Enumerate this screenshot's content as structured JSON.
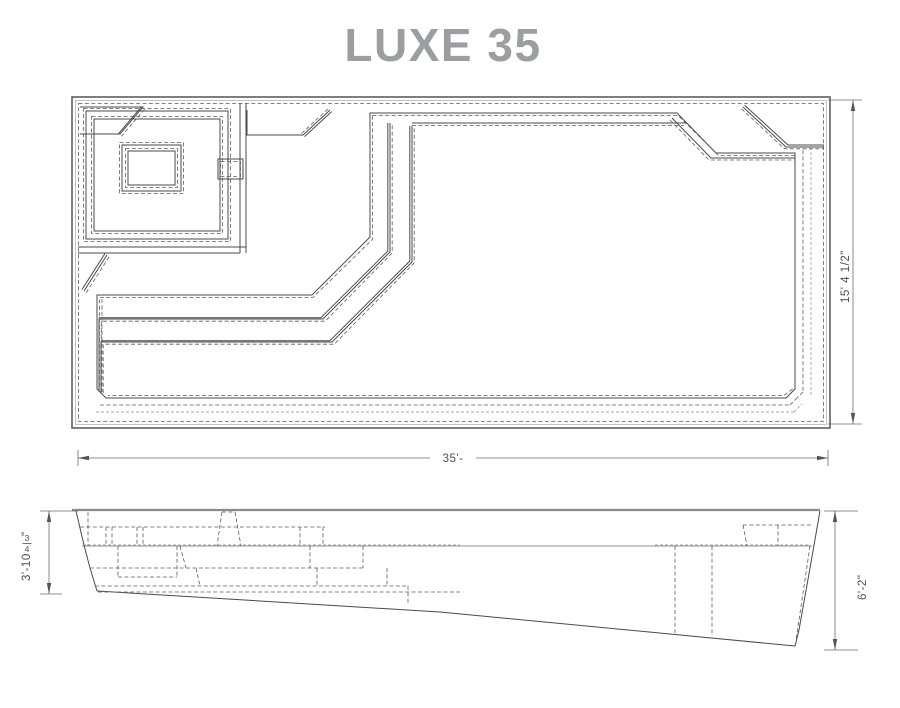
{
  "title": "LUXE 35",
  "colors": {
    "title_gray": "#9b9fa2",
    "line_dark": "#4a4a4a",
    "dim_text_gray": "#4f4f4f"
  },
  "plan_view": {
    "length_label": "35'-",
    "width_label": "15' 4 1/2\""
  },
  "side_view": {
    "shallow_depth": {
      "main": "3'-10",
      "fraction_numerator": "3",
      "fraction_denominator": "4",
      "unit_suffix": "\""
    },
    "deep_depth": "6'-2\""
  }
}
